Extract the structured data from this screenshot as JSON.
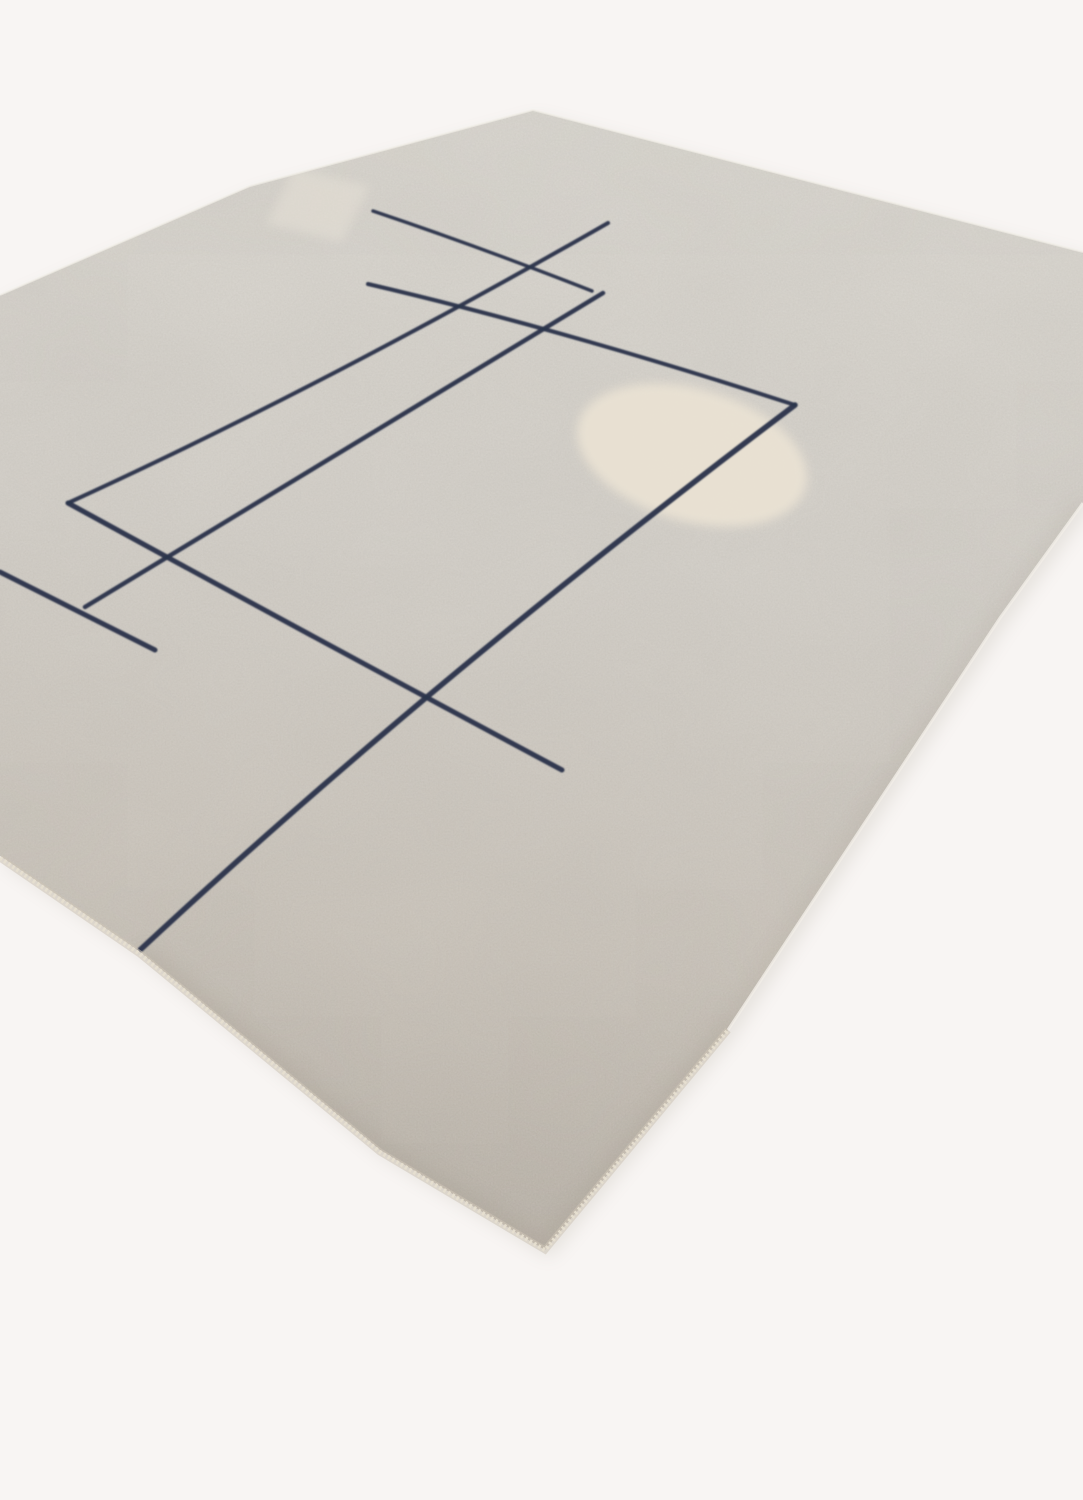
{
  "scene": {
    "width": 1083,
    "height": 1500,
    "background_color": "#f8f5f3",
    "rug": {
      "outline_path": "M533,110 L1083,252 L1083,503 L1000,618 L728,1030 L545,1250 L380,1150 L140,952 L0,856 L0,295 L250,186 Z",
      "pile_gradient": {
        "x1": 560,
        "y1": 110,
        "x2": 430,
        "y2": 1270,
        "stops": [
          {
            "offset": "0",
            "color": "#dcd9d2"
          },
          {
            "offset": "0.38",
            "color": "#d4d0c9"
          },
          {
            "offset": "0.72",
            "color": "#c8c1b7"
          },
          {
            "offset": "1",
            "color": "#b3aba0"
          }
        ]
      },
      "shadow_color": "#87816f",
      "binding_stitch_color": "#e6dfd0",
      "binding_under_color": "#cdc5b7",
      "binding_path": "M0,858 L140,954 L380,1152 L545,1250 L728,1030",
      "rim_light_top_path": "M0,295 L250,186 L533,110 L1083,252",
      "rim_light_right_path": "M1083,503 L1000,618 L728,1030",
      "rim_light_color": "#f1eee7",
      "inner_shade_bottom_path": "M140,952 L380,1150 L545,1250 L728,1030",
      "inner_shade_right_path": "M1083,503 L1000,618 L728,1030",
      "inner_shade_color": "#a1988a"
    },
    "pale_band": {
      "path": "M294,168 L370,186 L342,242 L266,224 Z",
      "color": "#e5e0d6",
      "opacity": 0.55
    },
    "accent_circle": {
      "cx": 692,
      "cy": 455,
      "rx": 118,
      "ry": 66,
      "rotate": 16,
      "color": "#ebe3d4",
      "opacity": 0.9
    },
    "pattern_lines": {
      "color": "#2b344b",
      "items": [
        {
          "name": "line-top-short",
          "d": "M373,211 Q480,247 592,291",
          "width": 3.5
        },
        {
          "name": "line-steep-long-1",
          "d": "M608,223 Q322,387 68,503",
          "width": 4
        },
        {
          "name": "line-shallow-main",
          "d": "M68,503 Q300,630 562,770",
          "width": 5
        },
        {
          "name": "line-shallow-to-circle",
          "d": "M368,284 Q565,330 795,405",
          "width": 4
        },
        {
          "name": "line-steep-long-2",
          "d": "M603,293 L85,607",
          "width": 4.5
        },
        {
          "name": "line-steep-circle",
          "d": "M795,405 Q430,680 140,950",
          "width": 5.5
        },
        {
          "name": "line-left-short",
          "d": "M0,572 L155,650",
          "width": 5
        }
      ]
    }
  }
}
